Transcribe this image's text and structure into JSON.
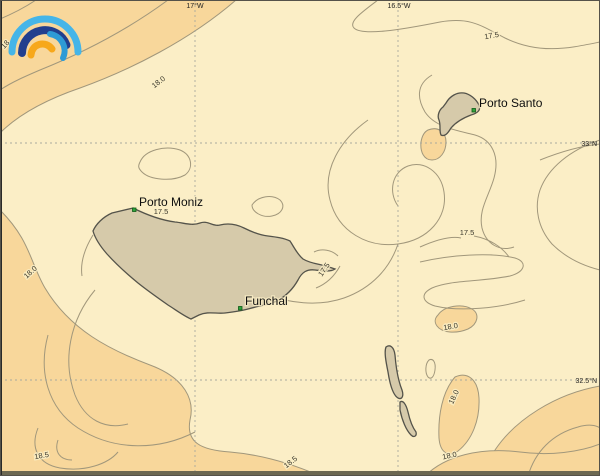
{
  "map_view": {
    "region_name": "Madeira archipelago SST contour map",
    "colors": {
      "ocean_cream": "#FBEEC6",
      "ocean_warm": "#F8D79B",
      "contour_line": "#A1977B",
      "island_fill": "#D6CAAA",
      "island_stroke": "#54534A",
      "grid_line": "#A9A99E",
      "marker_green": "#2FA33C",
      "frame_dark": "#6C6852"
    },
    "grid": {
      "top_ticks": [
        {
          "label": "17°W"
        },
        {
          "label": "16.5°W"
        }
      ],
      "right_ticks": [
        {
          "label": "33°N"
        },
        {
          "label": "32.5°N"
        }
      ]
    },
    "places": [
      {
        "name": "Porto Moniz"
      },
      {
        "name": "Funchal"
      },
      {
        "name": "Porto Santo"
      }
    ],
    "contour_labels": [
      "18",
      "18.0",
      "17.5",
      "17.5",
      "17.5",
      "17.5",
      "18.0",
      "18.0",
      "18.0",
      "18.5",
      "18.5",
      "18.0"
    ],
    "logo": {
      "name": "rainbow-arcs-logo",
      "arc_colors": [
        "#45B5E8",
        "#223F8E",
        "#2E9BD6",
        "#F7A81B"
      ]
    }
  }
}
